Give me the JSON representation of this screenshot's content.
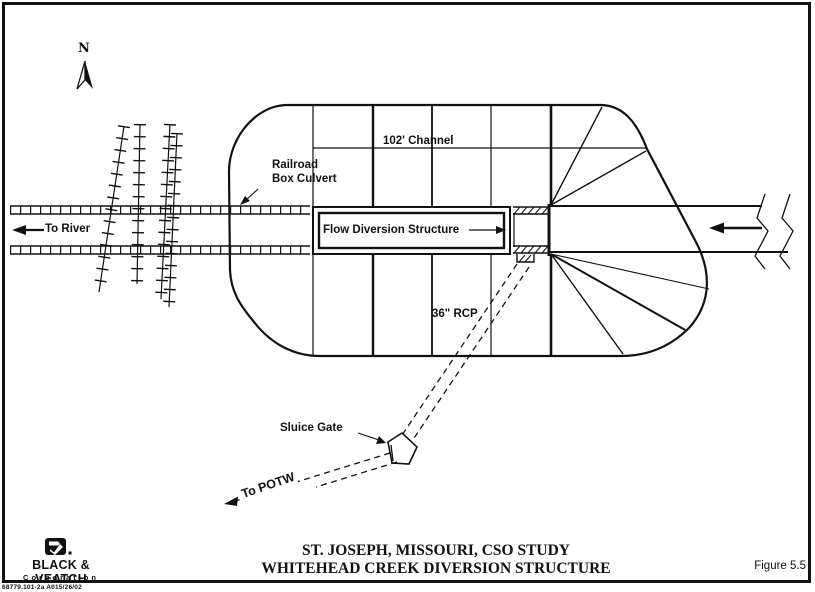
{
  "page": {
    "title_line1": "ST. JOSEPH, MISSOURI, CSO STUDY",
    "title_line2": "WHITEHEAD CREEK DIVERSION STRUCTURE",
    "figure_number": "Figure 5.5",
    "doc_number": "68779.101-2a A015/26/02"
  },
  "logo": {
    "company": "BLACK & VEATCH",
    "subtitle": "Corporation"
  },
  "north": {
    "label": "N"
  },
  "labels": {
    "channel": "102' Channel",
    "railroad_line1": "Railroad",
    "railroad_line2": "Box Culvert",
    "to_river": "To River",
    "flow_diversion": "Flow Diversion Structure",
    "rcp": "36\" RCP",
    "sluice_gate": "Sluice Gate",
    "to_potw": "To POTW"
  },
  "colors": {
    "ink": "#111111",
    "paper": "#ffffff"
  }
}
